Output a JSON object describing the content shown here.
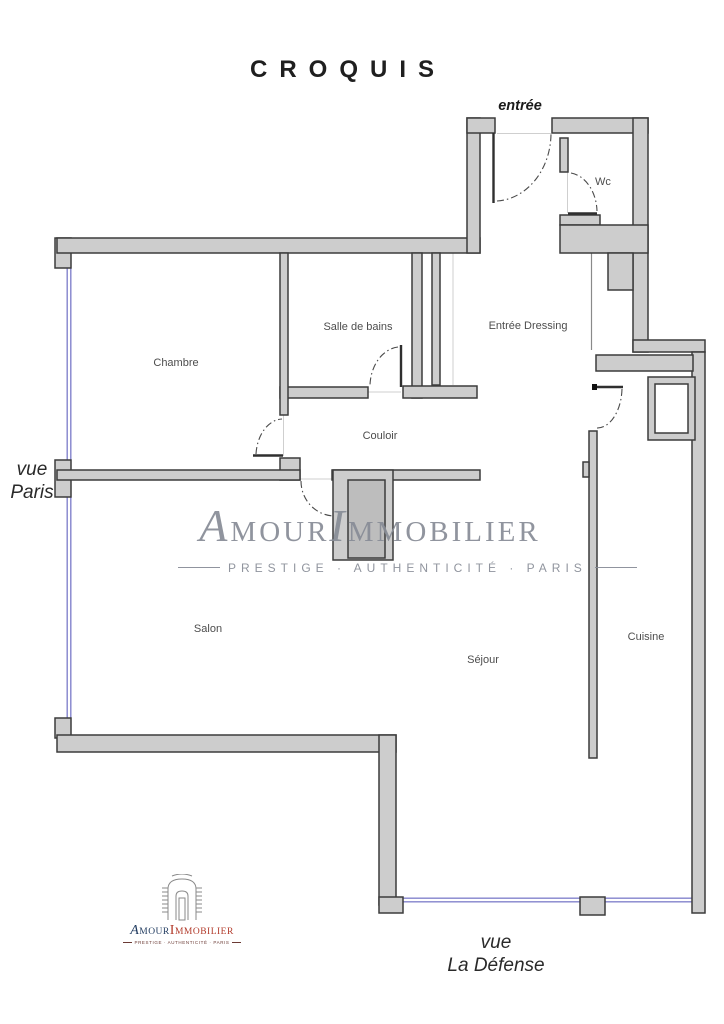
{
  "title": "CROQUIS",
  "rooms": {
    "wc": "Wc",
    "chambre": "Chambre",
    "salle_de_bains": "Salle de bains",
    "entree_dressing": "Entrée Dressing",
    "couloir": "Couloir",
    "salon": "Salon",
    "sejour": "Séjour",
    "cuisine": "Cuisine"
  },
  "annotations": {
    "entree": "entrée",
    "vue_paris_line1": "vue",
    "vue_paris_line2": "Paris",
    "vue_defense_line1": "vue",
    "vue_defense_line2": "La Défense"
  },
  "watermark": {
    "part1": "A",
    "part2": "MOUR",
    "part3": "I",
    "part4": "MMOBILIER",
    "subtitle": "PRESTIGE · AUTHENTICITÉ · PARIS"
  },
  "logo": {
    "part1": "A",
    "part2": "MOUR",
    "part3": "I",
    "part4": "MMOBILIER",
    "subtitle": "PRESTIGE · AUTHENTICITÉ · PARIS"
  },
  "colors": {
    "wall_fill": "#cdcdcd",
    "wall_stroke": "#3c3c3c",
    "window_line": "#8383cc",
    "watermark_gray": "#878c96",
    "logo_navy": "#1f3a5f",
    "logo_red": "#b23a2a"
  }
}
